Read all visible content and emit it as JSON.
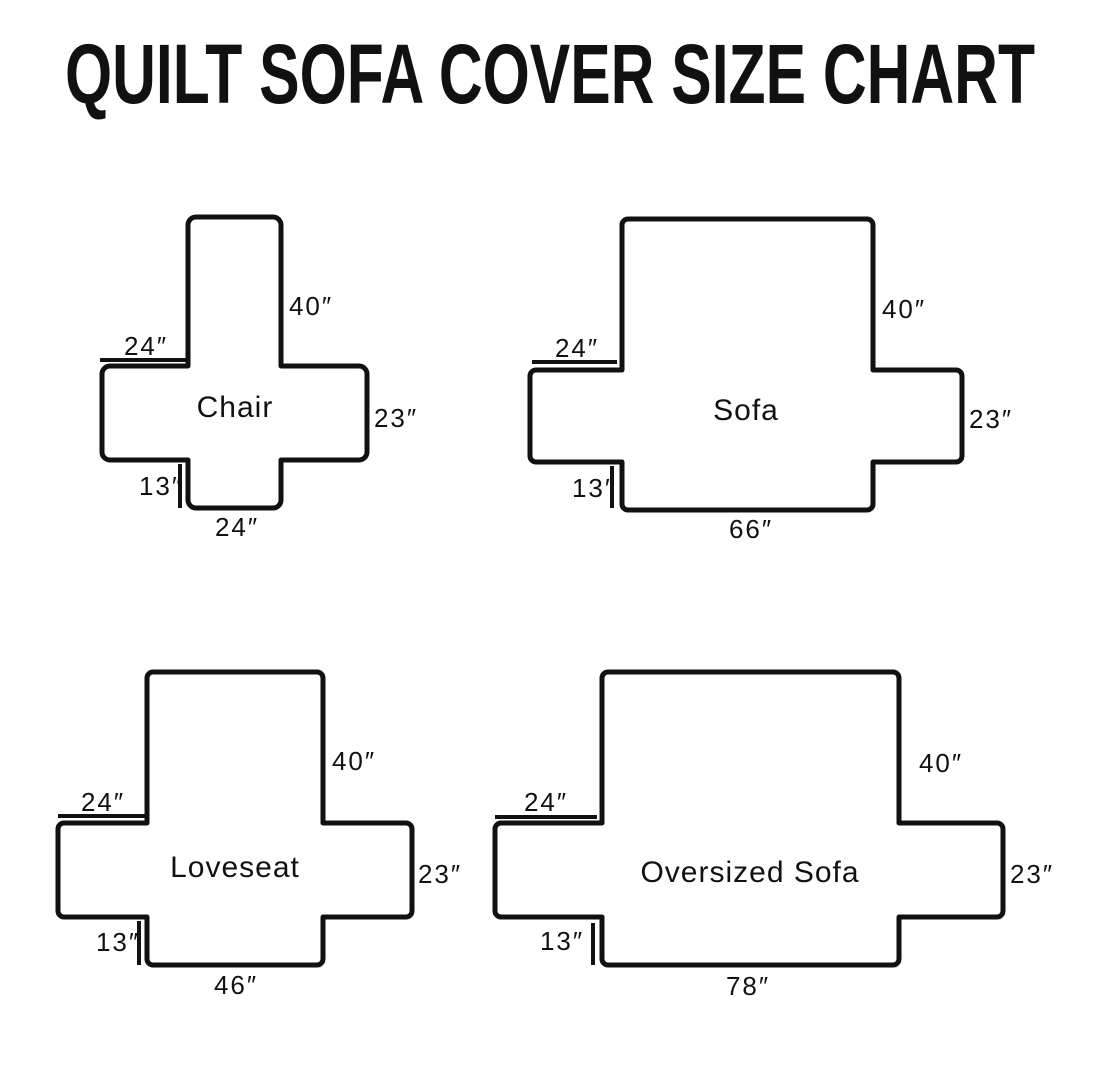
{
  "title": "QUILT SOFA COVER SIZE CHART",
  "colors": {
    "line": "#111111",
    "background": "#ffffff"
  },
  "diagrams": [
    {
      "name": "Chair",
      "back_height": "40″",
      "arm_width": "24″",
      "arm_depth": "23″",
      "skirt_drop": "13″",
      "seat_width": "24″"
    },
    {
      "name": "Sofa",
      "back_height": "40″",
      "arm_width": "24″",
      "arm_depth": "23″",
      "skirt_drop": "13″",
      "seat_width": "66″"
    },
    {
      "name": "Loveseat",
      "back_height": "40″",
      "arm_width": "24″",
      "arm_depth": "23″",
      "skirt_drop": "13″",
      "seat_width": "46″"
    },
    {
      "name": "Oversized Sofa",
      "back_height": "40″",
      "arm_width": "24″",
      "arm_depth": "23″",
      "skirt_drop": "13″",
      "seat_width": "78″"
    }
  ]
}
